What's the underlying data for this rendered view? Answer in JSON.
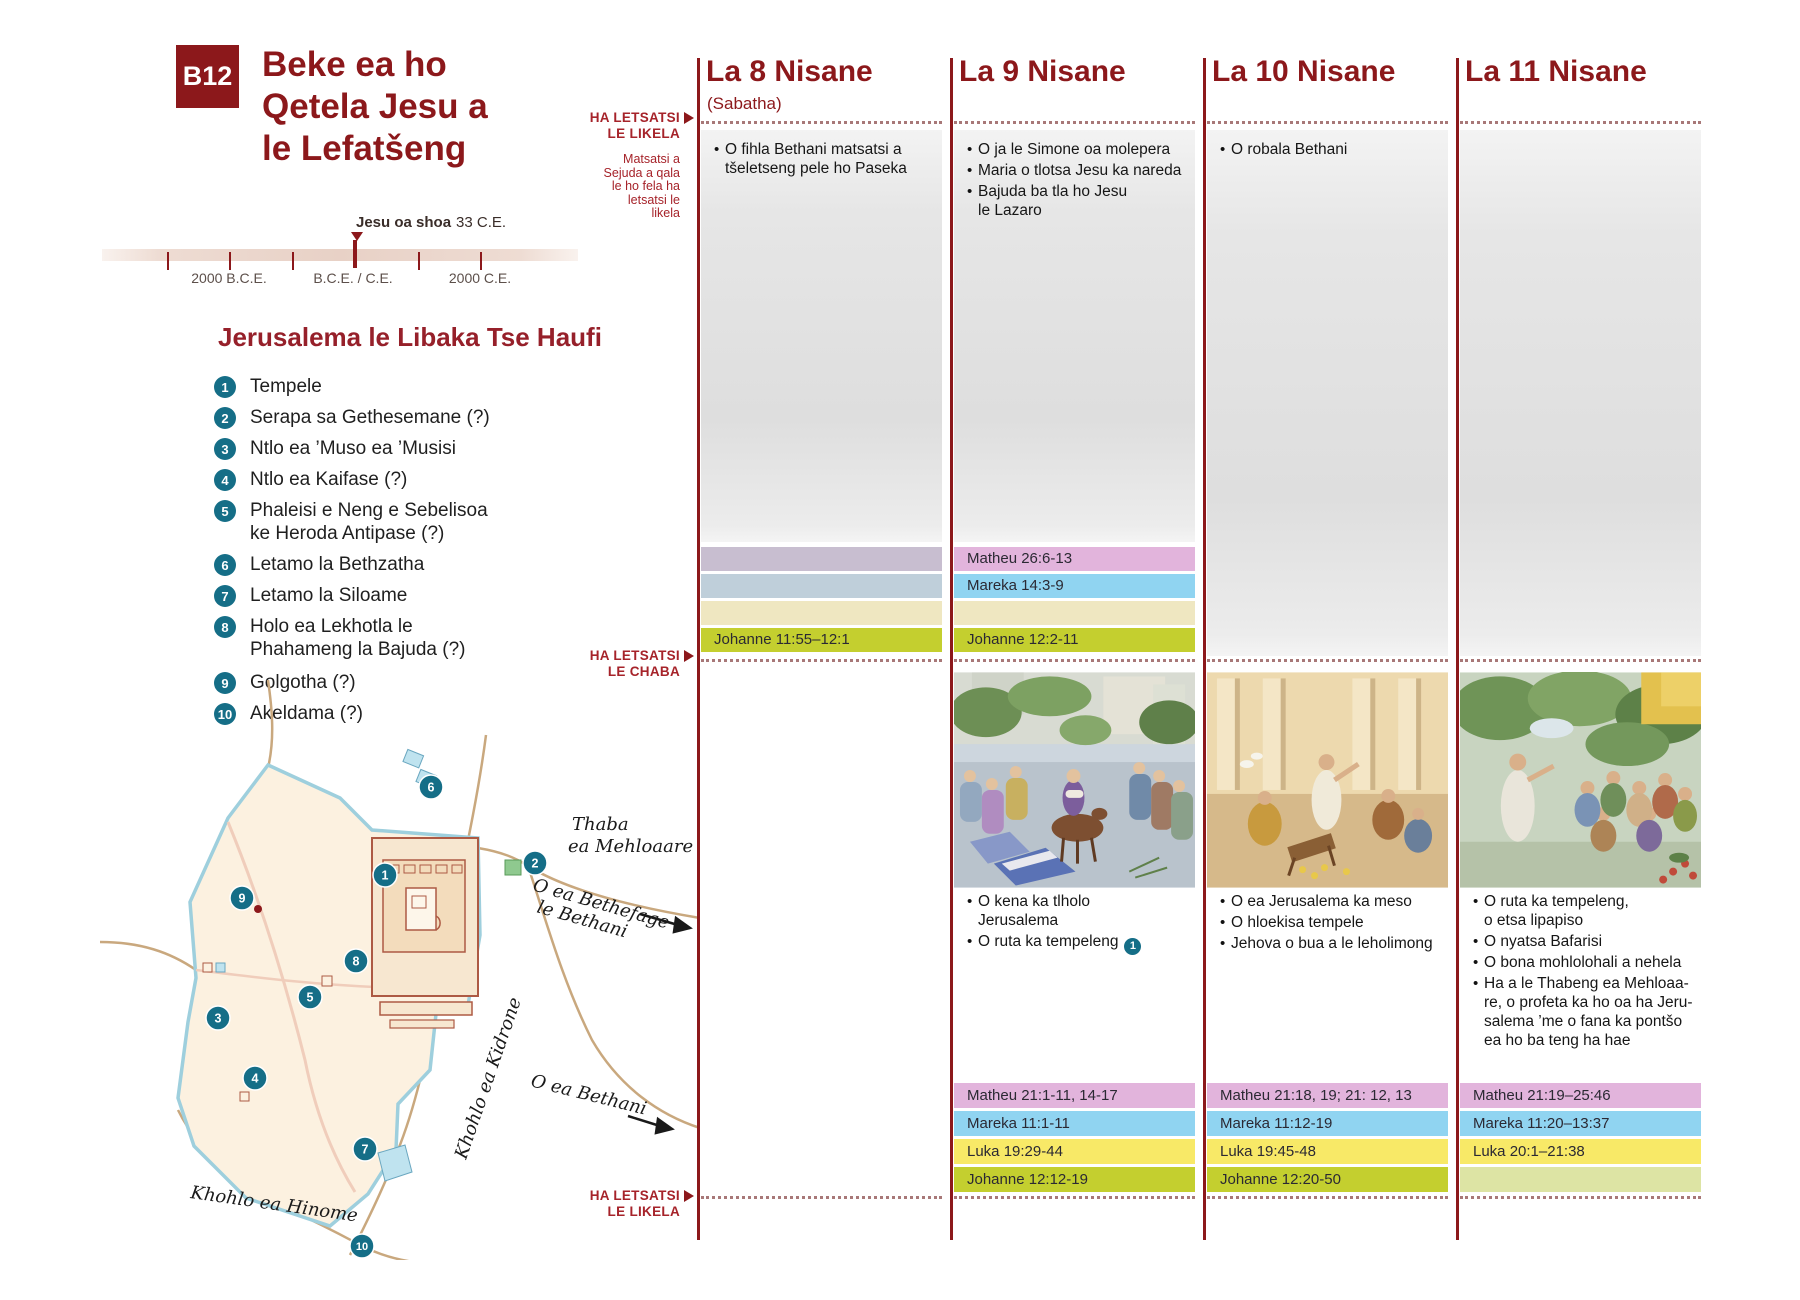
{
  "page": {
    "badge": "B12",
    "title": "Beke ea ho\nQetela Jesu a\nle Lefatšeng"
  },
  "timeline": {
    "event_label": "Jesu oa shoa",
    "event_year": "33 C.E.",
    "marker_icon": "triangle-down",
    "tick_labels": [
      "2000 B.C.E.",
      "B.C.E. / C.E.",
      "2000 C.E."
    ]
  },
  "legend": {
    "heading": "Jerusalema le Libaka Tse Haufi",
    "items": [
      {
        "num": "1",
        "label": "Tempele"
      },
      {
        "num": "2",
        "label": "Serapa sa Gethesemane (?)"
      },
      {
        "num": "3",
        "label": "Ntlo ea ’Muso ea ’Musisi"
      },
      {
        "num": "4",
        "label": "Ntlo ea Kaifase (?)"
      },
      {
        "num": "5",
        "label": "Phaleisi e Neng e Sebelisoa\nke Heroda Antipase (?)"
      },
      {
        "num": "6",
        "label": "Letamo la Bethzatha"
      },
      {
        "num": "7",
        "label": "Letamo la Siloame"
      },
      {
        "num": "8",
        "label": "Holo ea Lekhotla le\nPhahameng la Bajuda (?)"
      },
      {
        "num": "9",
        "label": "Golgotha (?)"
      },
      {
        "num": "10",
        "label": "Akeldama (?)"
      }
    ]
  },
  "map": {
    "mount_line1": "Thaba",
    "mount_line2": "ea Mehloaare",
    "road_bethphage_line1": "O ea Bethefage",
    "road_bethphage_line2": "le Bethani",
    "road_bethany": "O ea Bethani",
    "kidron": "Khohlo ea Kidrone",
    "hinnom": "Khohlo ea Hinome",
    "markers": [
      "1",
      "2",
      "3",
      "4",
      "5",
      "6",
      "7",
      "8",
      "9",
      "10"
    ]
  },
  "side_labels": {
    "marker_arrow_icon": "triangle-right",
    "sunset_top": "HA LETSATSI\nLE LIKELA",
    "note": "Matsatsi a\nSejuda a qala\nle ho fela ha\nletsatsi le\nlikela",
    "sunrise": "HA LETSATSI\nLE CHABA",
    "sunset_bottom": "HA LETSATSI\nLE LIKELA"
  },
  "columns": [
    {
      "header": "La 8 Nisane",
      "subheader": "(Sabatha)",
      "events_evening": [
        "O fihla Bethani matsatsi a\ntšeletseng pele ho Paseka"
      ],
      "mid_bands": {
        "matheu": "",
        "mareka": "",
        "luka": "",
        "johanne": "Johanne 11:55–12:1"
      }
    },
    {
      "header": "La 9 Nisane",
      "subheader": "",
      "events_evening": [
        "O ja le Simone oa molepera",
        "Maria o tlotsa Jesu ka nareda",
        "Bajuda ba tla ho Jesu\nle Lazaro"
      ],
      "mid_bands": {
        "matheu": "Matheu 26:6-13",
        "mareka": "Mareka 14:3-9",
        "luka": "",
        "johanne": "Johanne 12:2-11"
      },
      "events_day": [
        "O kena ka tlholo\nJerusalema",
        "O ruta ka tempeleng"
      ],
      "day_badge": "1",
      "bottom_bands": {
        "matheu": "Matheu 21:1-11, 14-17",
        "mareka": "Mareka 11:1-11",
        "luka": "Luka 19:29-44",
        "johanne": "Johanne 12:12-19"
      }
    },
    {
      "header": "La 10 Nisane",
      "subheader": "",
      "events_evening": [
        "O robala Bethani"
      ],
      "events_day": [
        "O ea Jerusalema ka meso",
        "O hloekisa tempele",
        "Jehova o bua a le leholimong"
      ],
      "bottom_bands": {
        "matheu": "Matheu 21:18, 19; 21: 12, 13",
        "mareka": "Mareka 11:12-19",
        "luka": "Luka 19:45-48",
        "johanne": "Johanne 12:20-50"
      }
    },
    {
      "header": "La 11 Nisane",
      "subheader": "",
      "events_evening": [],
      "events_day": [
        "O ruta ka tempeleng,\no etsa lipapiso",
        "O nyatsa Bafarisi",
        "O bona mohlolohali a nehela",
        "Ha a le Thabeng ea Mehloaa-\nre, o profeta ka ho oa ha Jeru-\nsalema ’me o fana ka pontšo\nea ho ba teng ha hae"
      ],
      "bottom_bands": {
        "matheu": "Matheu 21:19–25:46",
        "mareka": "Mareka 11:20–13:37",
        "luka": "Luka 20:1–21:38",
        "johanne": ""
      }
    }
  ],
  "colors": {
    "maroon": "#8c181b",
    "label_red": "#a6232a",
    "teal": "#156e87",
    "band_matheu": "#e2b4dc",
    "band_mareka": "#90d4f1",
    "band_luka": "#f8e967",
    "band_johanne": "#c4cf2f",
    "band_empty_matheu": "#c8bed0",
    "band_empty_mareka": "#bfcfda",
    "band_empty_luka": "#efe7c1",
    "band_empty_johanne": "#dde4a4"
  }
}
